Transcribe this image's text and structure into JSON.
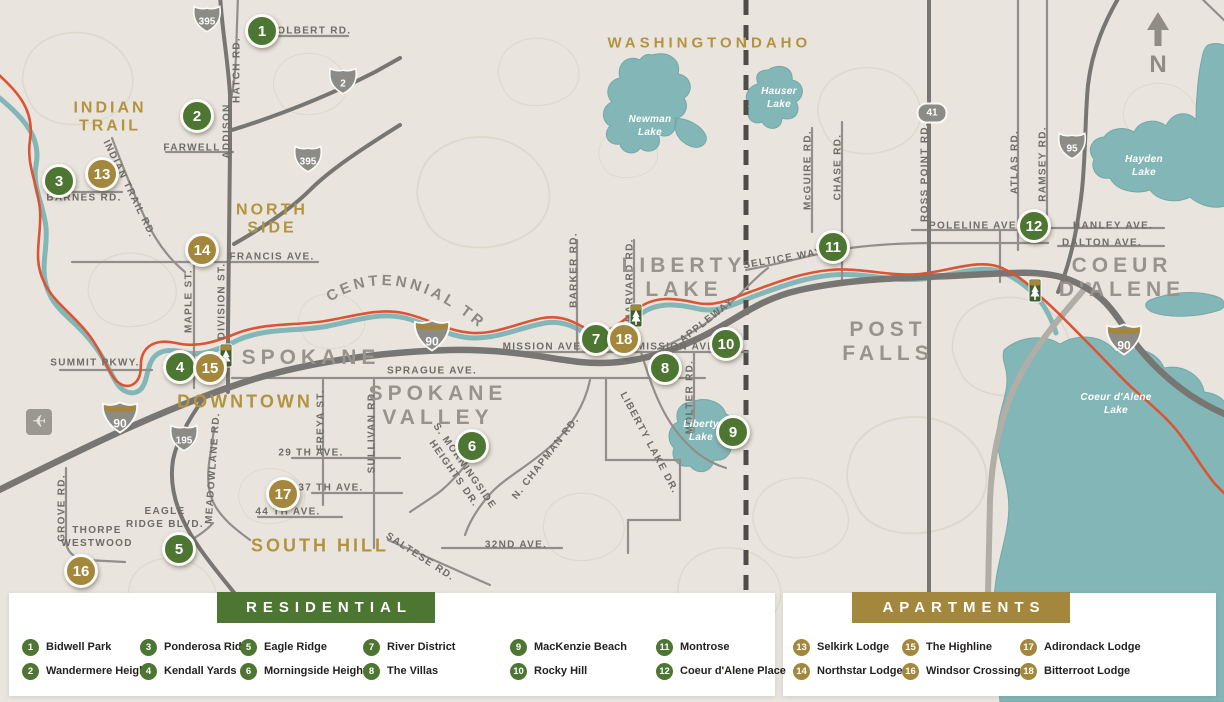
{
  "map": {
    "trail_label": "CENTENNIAL TRAIL",
    "compass": {
      "label": "N"
    },
    "regions": [
      {
        "text": "INDIAN\nTRAIL"
      },
      {
        "text": "NORTH\nSIDE"
      },
      {
        "text": "DOWNTOWN"
      },
      {
        "text": "SOUTH HILL"
      },
      {
        "text": "WASHINGTON"
      },
      {
        "text": "IDAHO"
      },
      {
        "text": "SPOKANE"
      },
      {
        "text": "SPOKANE\nVALLEY"
      },
      {
        "text": "LIBERTY\nLAKE"
      },
      {
        "text": "POST\nFALLS"
      },
      {
        "text": "COEUR\nD'ALENE"
      }
    ],
    "road_labels": [
      {
        "t": "COLBERT RD."
      },
      {
        "t": "HATCH RD."
      },
      {
        "t": "FARWELL"
      },
      {
        "t": "ADDISON"
      },
      {
        "t": "BARNES RD."
      },
      {
        "t": "INDIAN TRAIL RD."
      },
      {
        "t": "FRANCIS AVE."
      },
      {
        "t": "MAPLE ST."
      },
      {
        "t": "DIVISION ST."
      },
      {
        "t": "SUMMIT PKWY."
      },
      {
        "t": "SPRAGUE AVE."
      },
      {
        "t": "MISSION AVE."
      },
      {
        "t": "MISSION AVE."
      },
      {
        "t": "29 TH AVE."
      },
      {
        "t": "37 TH AVE."
      },
      {
        "t": "44 TH AVE."
      },
      {
        "t": "FREYA ST."
      },
      {
        "t": "SULLIVAN RD."
      },
      {
        "t": "MEADOWLANE RD."
      },
      {
        "t": "GROVE RD."
      },
      {
        "t": "THORPE\nWESTWOOD"
      },
      {
        "t": "EAGLE\nRIDGE BLVD."
      },
      {
        "t": "SALTESE RD."
      },
      {
        "t": "32ND AVE."
      },
      {
        "t": "S. MORNINGSIDE\nHEIGHTS DR."
      },
      {
        "t": "N. CHAPMAN RD."
      },
      {
        "t": "BARKER RD."
      },
      {
        "t": "HARVARD RD."
      },
      {
        "t": "SELTICE WAY"
      },
      {
        "t": "APPLEWAY"
      },
      {
        "t": "MOLTER RD."
      },
      {
        "t": "LIBERTY LAKE DR."
      },
      {
        "t": "McGUIRE RD."
      },
      {
        "t": "CHASE RD."
      },
      {
        "t": "ROSS POINT RD."
      },
      {
        "t": "ATLAS RD."
      },
      {
        "t": "RAMSEY RD."
      },
      {
        "t": "POLELINE AVE."
      },
      {
        "t": "HANLEY AVE."
      },
      {
        "t": "DALTON AVE."
      }
    ],
    "lake_labels": [
      {
        "t": "Newman\nLake"
      },
      {
        "t": "Hauser\nLake"
      },
      {
        "t": "Hayden\nLake"
      },
      {
        "t": "Liberty\nLake"
      },
      {
        "t": "Coeur d'Alene\nLake"
      }
    ],
    "shields": [
      {
        "num": "395",
        "system": "US"
      },
      {
        "num": "2",
        "system": "US"
      },
      {
        "num": "395",
        "system": "US"
      },
      {
        "num": "90",
        "system": "Interstate"
      },
      {
        "num": "195",
        "system": "US"
      },
      {
        "num": "90",
        "system": "Interstate"
      },
      {
        "num": "41",
        "system": "State"
      },
      {
        "num": "95",
        "system": "US"
      },
      {
        "num": "90",
        "system": "Interstate"
      }
    ],
    "markers": [
      {
        "num": "1",
        "category": "residential"
      },
      {
        "num": "2",
        "category": "residential"
      },
      {
        "num": "3",
        "category": "residential"
      },
      {
        "num": "4",
        "category": "residential"
      },
      {
        "num": "5",
        "category": "residential"
      },
      {
        "num": "6",
        "category": "residential"
      },
      {
        "num": "7",
        "category": "residential"
      },
      {
        "num": "8",
        "category": "residential"
      },
      {
        "num": "9",
        "category": "residential"
      },
      {
        "num": "10",
        "category": "residential"
      },
      {
        "num": "11",
        "category": "residential"
      },
      {
        "num": "12",
        "category": "residential"
      },
      {
        "num": "13",
        "category": "apartments"
      },
      {
        "num": "14",
        "category": "apartments"
      },
      {
        "num": "15",
        "category": "apartments"
      },
      {
        "num": "16",
        "category": "apartments"
      },
      {
        "num": "17",
        "category": "apartments"
      },
      {
        "num": "18",
        "category": "apartments"
      }
    ]
  },
  "legend": {
    "residential": {
      "title": "RESIDENTIAL",
      "items": [
        {
          "num": "1",
          "label": "Bidwell Park"
        },
        {
          "num": "2",
          "label": "Wandermere Heights"
        },
        {
          "num": "3",
          "label": "Ponderosa Ridge"
        },
        {
          "num": "4",
          "label": "Kendall Yards"
        },
        {
          "num": "5",
          "label": "Eagle Ridge"
        },
        {
          "num": "6",
          "label": "Morningside Heights"
        },
        {
          "num": "7",
          "label": "River District"
        },
        {
          "num": "8",
          "label": "The Villas"
        },
        {
          "num": "9",
          "label": "MacKenzie Beach"
        },
        {
          "num": "10",
          "label": "Rocky Hill"
        },
        {
          "num": "11",
          "label": "Montrose"
        },
        {
          "num": "12",
          "label": "Coeur d'Alene Place"
        }
      ]
    },
    "apartments": {
      "title": "APARTMENTS",
      "items": [
        {
          "num": "13",
          "label": "Selkirk Lodge"
        },
        {
          "num": "14",
          "label": "Northstar Lodge"
        },
        {
          "num": "15",
          "label": "The Highline"
        },
        {
          "num": "16",
          "label": "Windsor Crossing"
        },
        {
          "num": "17",
          "label": "Adirondack Lodge"
        },
        {
          "num": "18",
          "label": "Bitterroot Lodge"
        }
      ]
    }
  },
  "colors": {
    "residential_green": "#4d7632",
    "apartment_gold": "#a3873c",
    "water_teal": "#83b6b6",
    "trail_red": "#db5433",
    "map_background": "#e9e5de",
    "highway_gray": "#787672",
    "label_gold": "#b2943e",
    "label_gray": "#98948d"
  }
}
